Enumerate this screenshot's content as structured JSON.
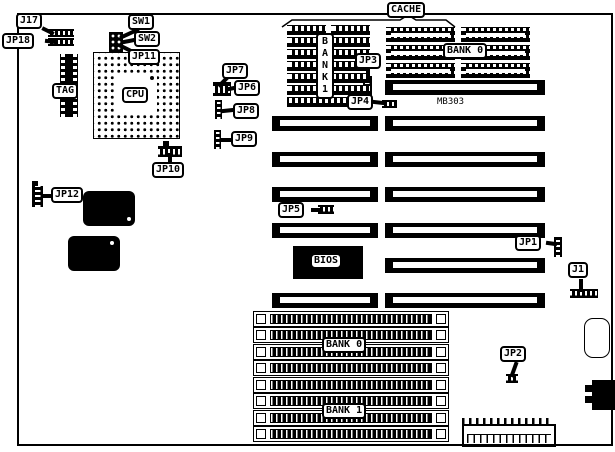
{
  "board": {
    "model_text": "MB303",
    "colors": {
      "ink": "#000000",
      "paper": "#ffffff"
    },
    "callouts": {
      "j17": "J17",
      "jp18": "JP18",
      "sw1": "SW1",
      "sw2": "SW2",
      "jp11": "JP11",
      "jp10": "JP10",
      "jp12": "JP12",
      "jp7": "JP7",
      "jp6": "JP6",
      "jp8": "JP8",
      "jp9": "JP9",
      "jp3": "JP3",
      "jp4": "JP4",
      "jp5": "JP5",
      "jp1": "JP1",
      "j1": "J1",
      "jp2": "JP2",
      "cache": "CACHE"
    },
    "chips": {
      "cpu": "CPU",
      "tag": "TAG",
      "bios": "BIOS"
    },
    "memory": {
      "cache_bank0": "BANK 0",
      "cache_bank1": "BANK1",
      "simm_bank0": "BANK 0",
      "simm_bank1": "BANK 1"
    }
  }
}
